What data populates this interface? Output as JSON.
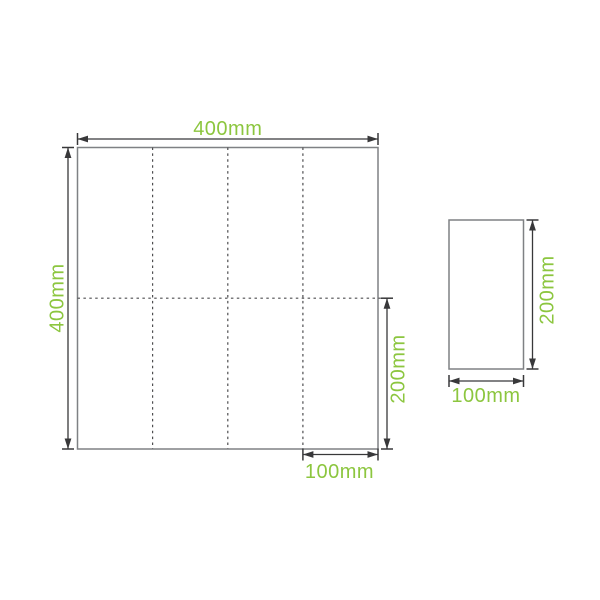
{
  "diagram": {
    "title": "napkin-fold-dimension-diagram",
    "accent_color": "#8CC63F",
    "outline_color": "#7F8184",
    "fold_line_color": "#4E4E50",
    "dimension_color": "#38383A",
    "background_color": "#FFFFFF",
    "open_sheet": {
      "width_label": "400mm",
      "height_label": "400mm",
      "half_height_label": "200mm",
      "panel_width_label": "100mm",
      "fold_columns": 4,
      "fold_rows": 2
    },
    "folded_sheet": {
      "width_label": "100mm",
      "height_label": "200mm"
    }
  }
}
